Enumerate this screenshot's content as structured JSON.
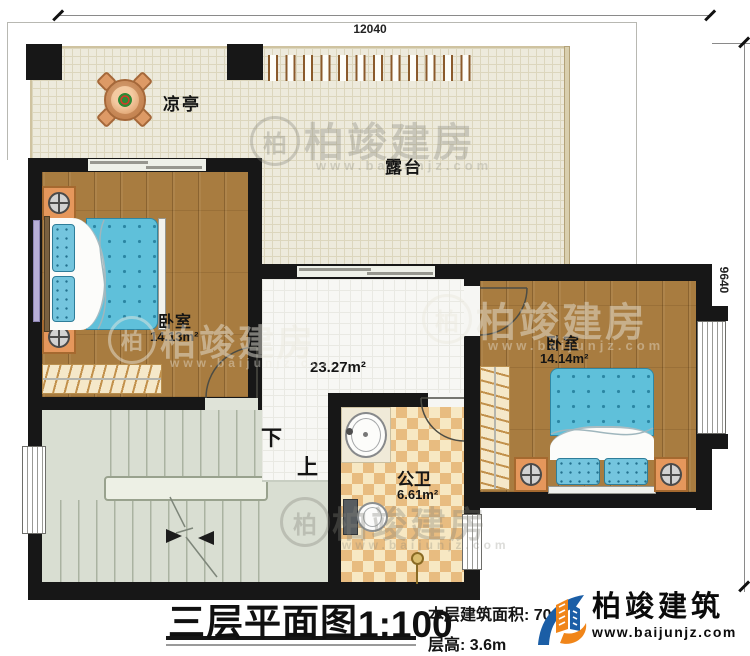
{
  "dimensions": {
    "top": "12040",
    "right": "9640"
  },
  "rooms": {
    "pavilion_label": "凉亭",
    "terrace_label": "露台",
    "bedroom_left": {
      "label": "卧室",
      "area": "14.13m²"
    },
    "bedroom_right": {
      "label": "卧室",
      "area": "14.14m²"
    },
    "hall_area": "23.27m²",
    "bathroom": {
      "label": "公卫",
      "area": "6.61m²"
    },
    "stairs": {
      "down_label": "下",
      "up_label": "上"
    }
  },
  "title_block": {
    "title": "三层平面图",
    "scale": "1:100",
    "floor_area_label": "本层建筑面积: 70",
    "floor_height_label": "层高: 3.6m"
  },
  "logo": {
    "name": "柏竣建筑",
    "website": "www.baijunjz.com"
  },
  "watermark": {
    "name": "柏竣建房",
    "website": "www.baijunjz.com",
    "seal_char": "柏"
  },
  "colors": {
    "wall": "#171717",
    "wood_floor": "#a87c40",
    "terrace_floor": "#edeadc",
    "hall_floor": "#f7f7f4",
    "stairs_floor": "#d9ded2",
    "tile_light": "#f7e8c3",
    "tile_dark": "#e8bc80",
    "bed_blue": "#5fc0da",
    "furniture_orange": "#e5975c",
    "logo_blue": "#1b5ea6",
    "logo_orange": "#f08519"
  }
}
